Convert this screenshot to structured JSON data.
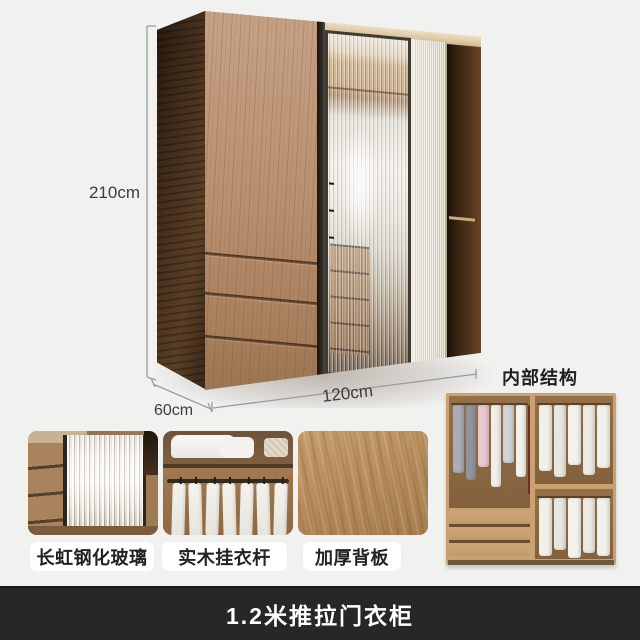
{
  "banner": {
    "title": "1.2米推拉门衣柜"
  },
  "dimensions": {
    "height": "210cm",
    "width": "120cm",
    "depth": "60cm"
  },
  "interior": {
    "label": "内部结构"
  },
  "features": [
    {
      "label": "长虹钢化玻璃"
    },
    {
      "label": "实木挂衣杆"
    },
    {
      "label": "加厚背板"
    }
  ],
  "colors": {
    "background": "#f1f1ef",
    "banner_bg": "#272727",
    "banner_text": "#ffffff",
    "dimension_line": "#9b9b9b",
    "pill_bg": "#ffffff",
    "label_text": "#222222",
    "wood_front": "#b98f6d",
    "wood_dark_side": "#402b19",
    "cream_door": "#e6decd",
    "interior_wood": "#c9a173"
  }
}
